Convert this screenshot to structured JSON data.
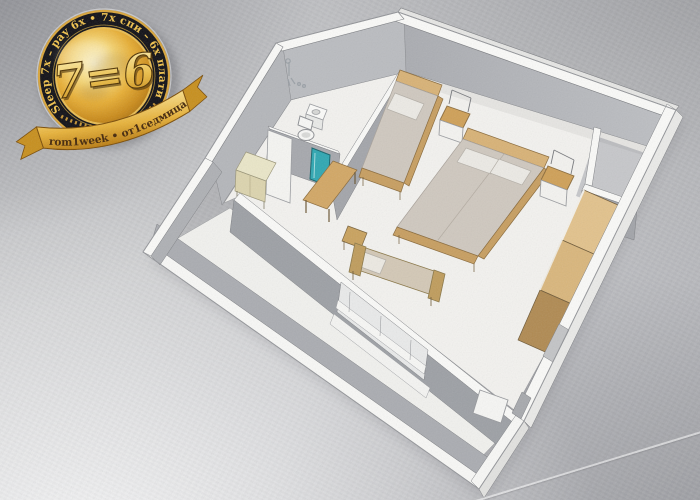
{
  "badge": {
    "arc_text": "Sleep 7x – pay 6x  •  7х спи – 6х плати",
    "center_text": "7=6",
    "ribbon_text": "from1week • от1седмица",
    "colors": {
      "ring": "#101016",
      "gold": "#e9b23f",
      "gold_light": "#fdf4c8",
      "gold_deep": "#9c660e",
      "arc_text_color": "#f0c24d",
      "ribbon_text_color": "#45280a"
    }
  },
  "floorplan": {
    "rooms": [
      {
        "name": "bathroom"
      },
      {
        "name": "hallway"
      },
      {
        "name": "main-room"
      },
      {
        "name": "balcony"
      }
    ],
    "furniture": [
      "shower",
      "sink",
      "toilet",
      "bathroom-door",
      "hall-cabinet",
      "mirror-panel",
      "desk",
      "chair",
      "single-bed",
      "nightstand",
      "double-bed",
      "nightstand",
      "corner-niche",
      "wardrobe",
      "bench-sofa",
      "entry-door",
      "balcony-parapet"
    ],
    "colors": {
      "floor": "#f3f2ef",
      "wall_face": "#a9abb0",
      "wall_top": "#fafaf8",
      "wood": "#cfa25f",
      "wood_light": "#e2c28c",
      "wood_dark": "#b08a52",
      "mattress": "#cfc8bf",
      "pillow": "#eceae5",
      "teal_panel": "#2fa7b2"
    }
  }
}
